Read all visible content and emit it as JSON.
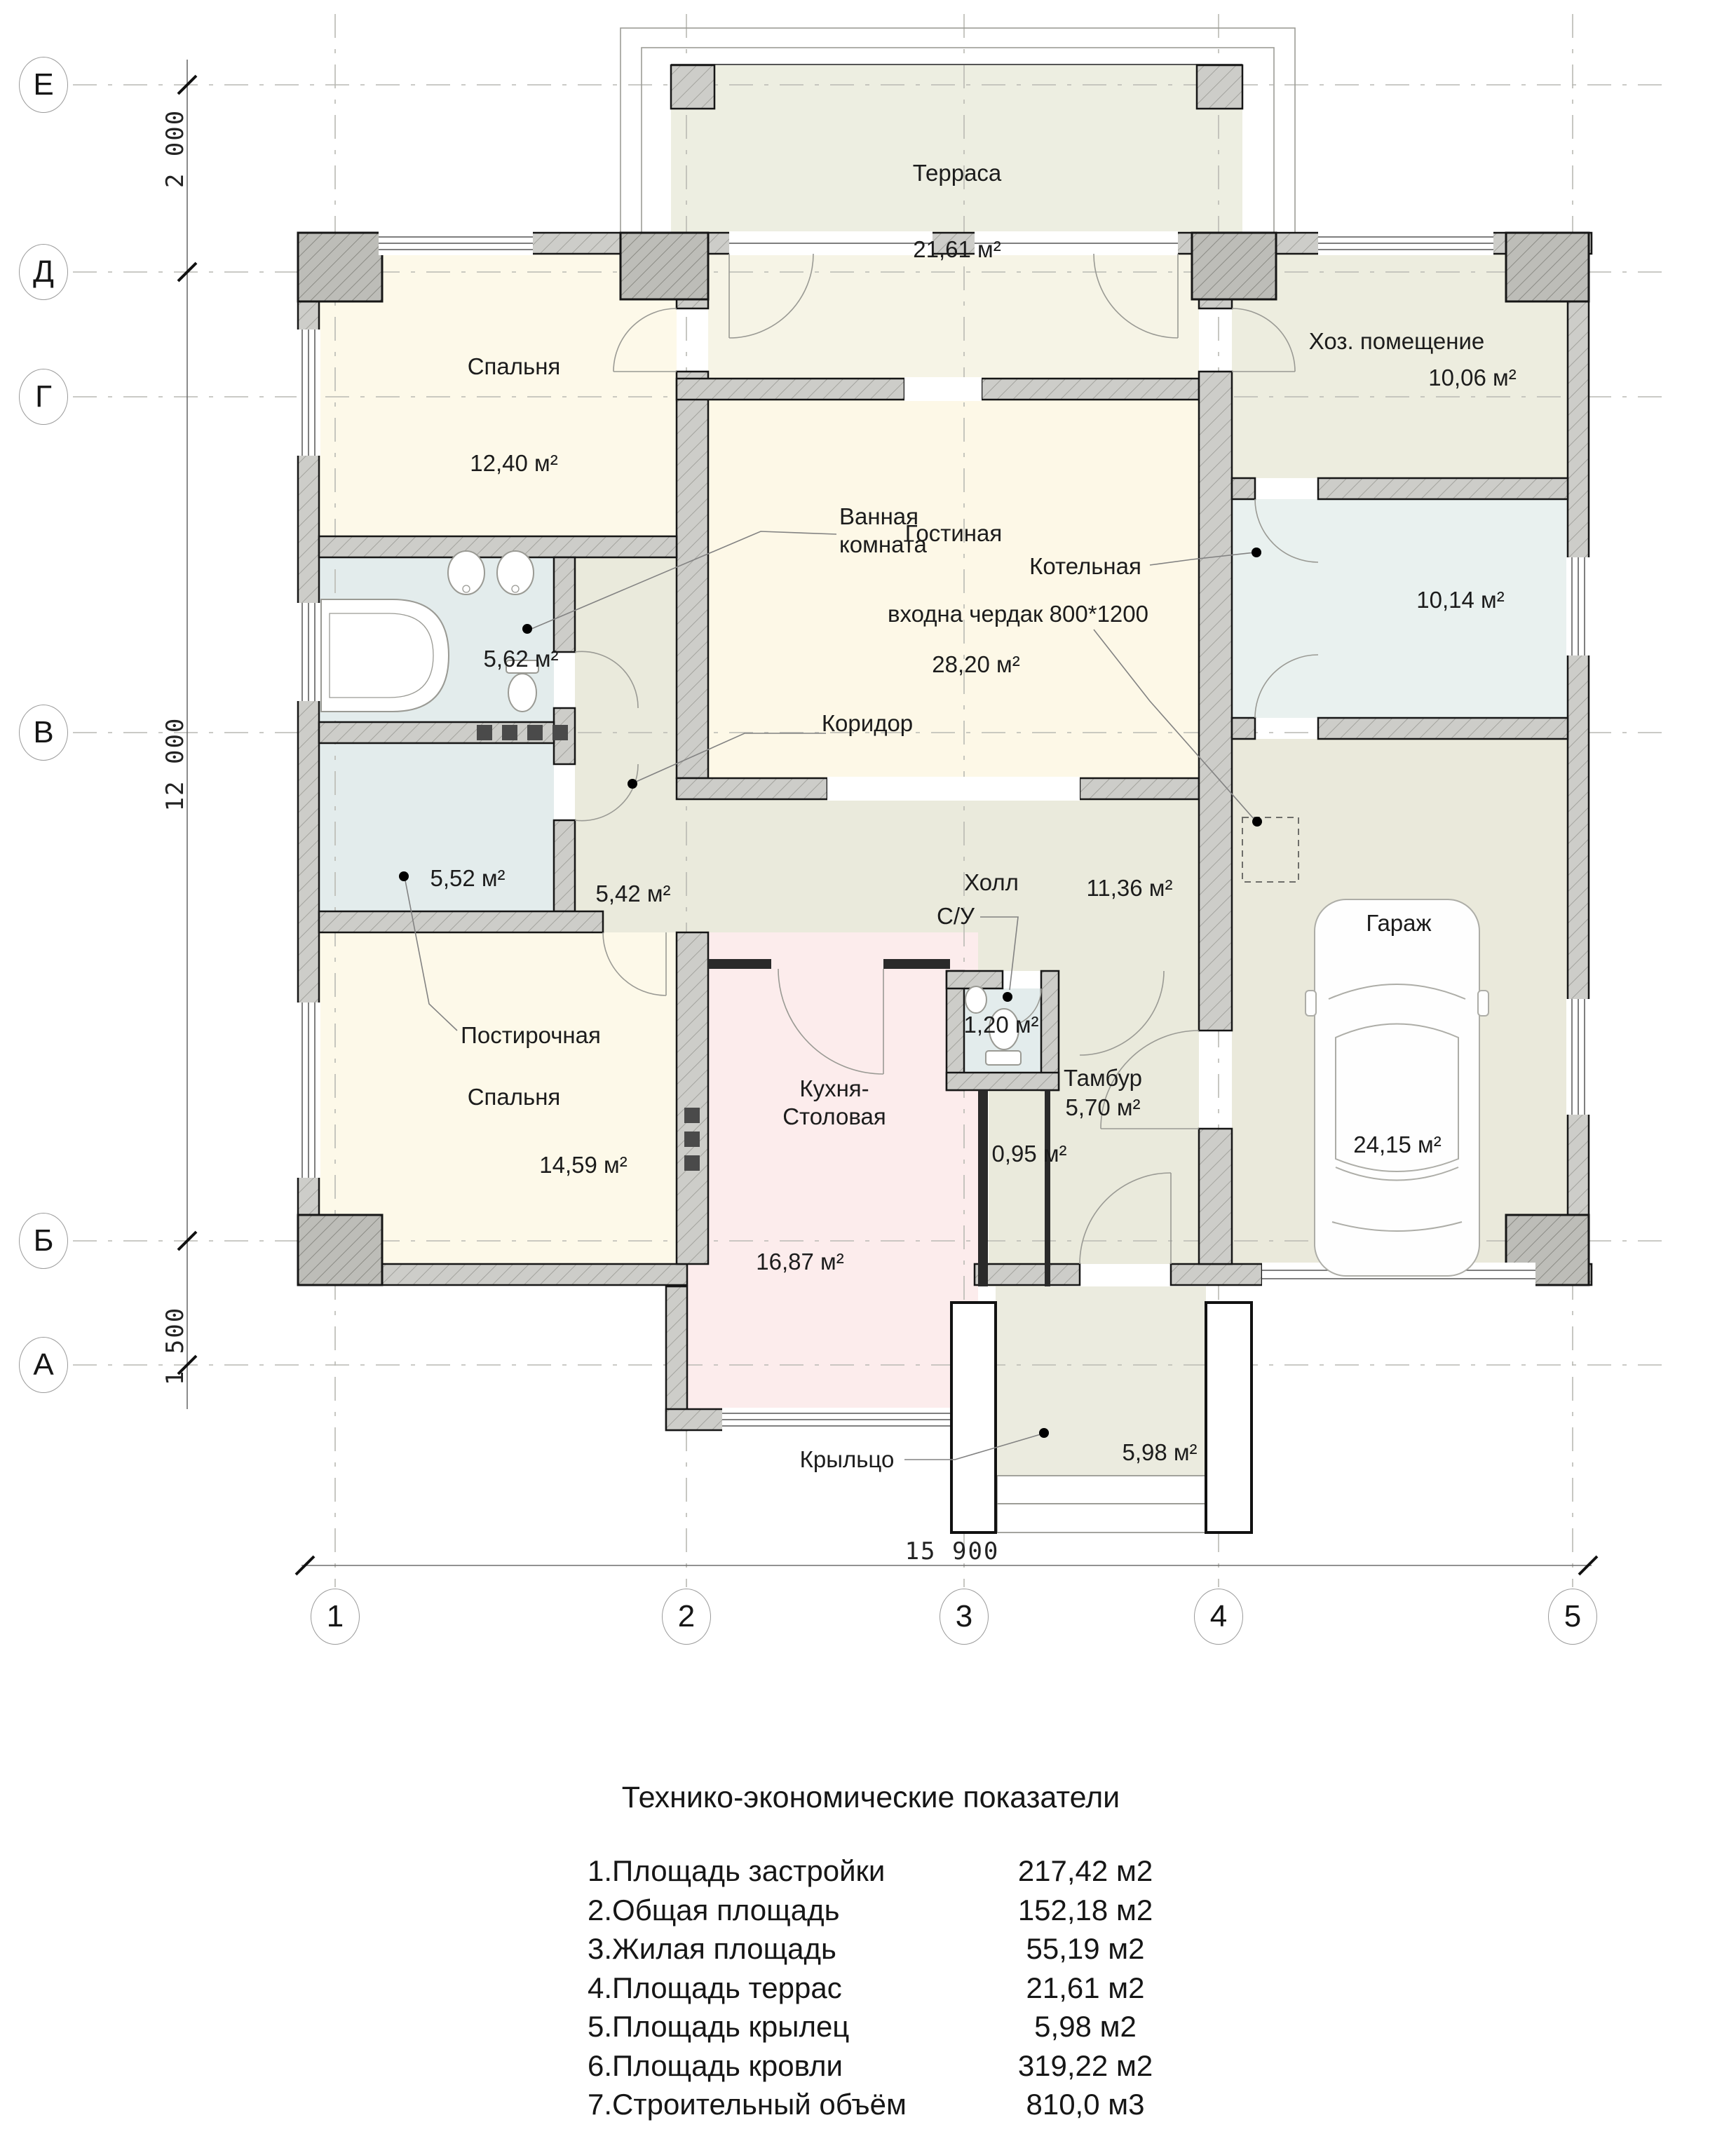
{
  "axes": {
    "rows": [
      "Е",
      "Д",
      "Г",
      "В",
      "Б",
      "А"
    ],
    "cols": [
      "1",
      "2",
      "3",
      "4",
      "5"
    ]
  },
  "dims": {
    "left_top": "2 000",
    "left_mid": "12 000",
    "left_bottom": "1 500",
    "bottom": "15 900"
  },
  "rooms": {
    "terrace": {
      "name": "Терраса",
      "area": "21,61 м²"
    },
    "bedroom1": {
      "name": "Спальня",
      "area": "12,40 м²"
    },
    "utility": {
      "name": "Хоз. помещение",
      "area": "10,06 м²"
    },
    "bathroom": {
      "name": "Ванная комната",
      "area": "5,62 м²"
    },
    "living": {
      "name": "Гостиная",
      "area": "28,20 м²"
    },
    "boiler": {
      "name": "Котельная",
      "area": "10,14 м²"
    },
    "corridor": {
      "name": "Коридор",
      "area": "5,42 м²"
    },
    "laundry": {
      "name": "Постирочная",
      "area": "5,52 м²"
    },
    "hall": {
      "name": "Холл",
      "area": "11,36 м²"
    },
    "wc": {
      "name": "С/У",
      "area": "1,20 м²"
    },
    "garage": {
      "name": "Гараж",
      "area": "24,15 м²"
    },
    "bedroom2": {
      "name": "Спальня",
      "area": "14,59 м²"
    },
    "kitchen": {
      "name": "Кухня-Столовая",
      "area": "16,87 м²"
    },
    "tambour": {
      "name": "Тамбур",
      "area": "5,70 м²"
    },
    "passage": {
      "area": "0,95 м²"
    },
    "porch": {
      "name": "Крыльцо",
      "area": "5,98 м²"
    }
  },
  "notes": {
    "attic": "входна чердак 800*1200"
  },
  "table": {
    "title": "Технико-экономические показатели",
    "rows": [
      {
        "label": "1.Площадь застройки",
        "value": "217,42 м2"
      },
      {
        "label": "2.Общая площадь",
        "value": "152,18 м2"
      },
      {
        "label": "3.Жилая площадь",
        "value": "55,19 м2"
      },
      {
        "label": "4.Площадь террас",
        "value": "21,61 м2"
      },
      {
        "label": "5.Площадь крылец",
        "value": "5,98 м2"
      },
      {
        "label": "6.Площадь кровли",
        "value": "319,22 м2"
      },
      {
        "label": "7.Строительный объём",
        "value": "810,0 м3"
      }
    ]
  }
}
